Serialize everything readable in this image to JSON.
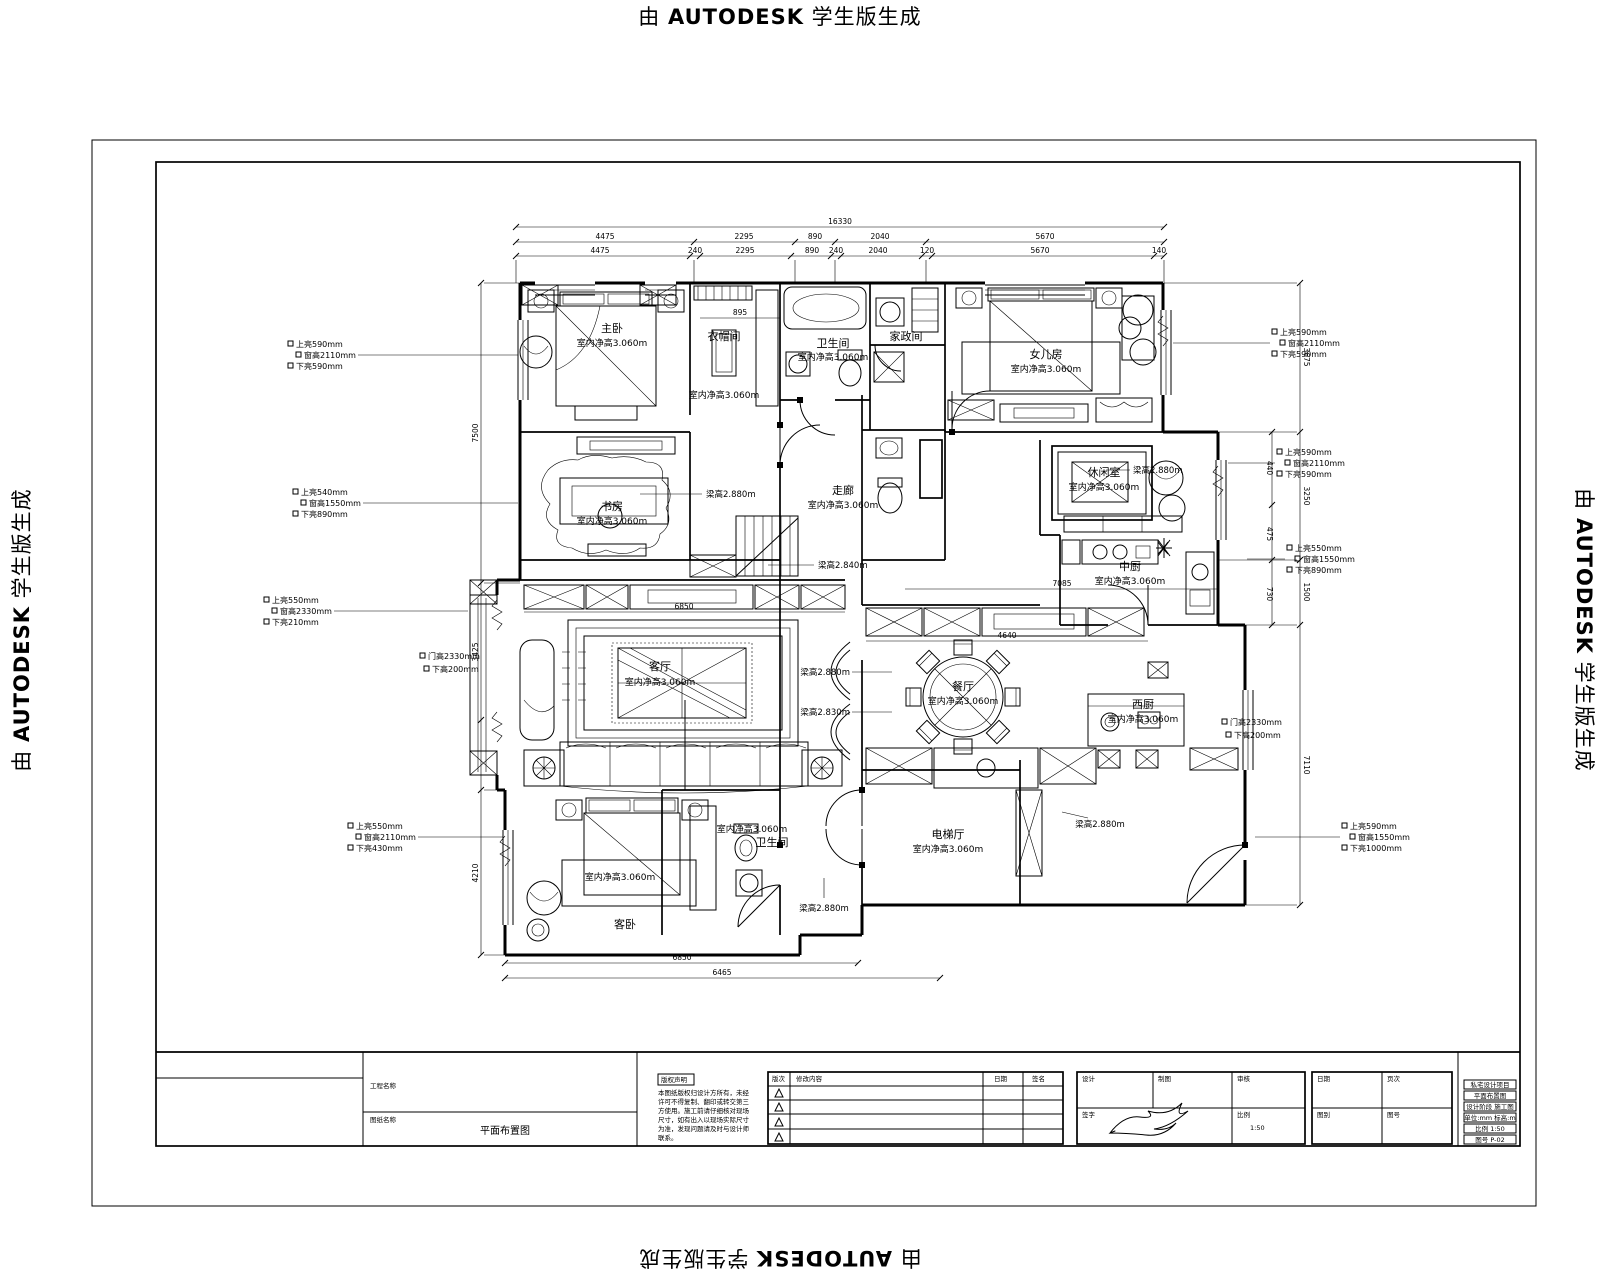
{
  "watermark": {
    "prefix": "由 ",
    "brand": "AUTODESK",
    "suffix": " 学生版生成"
  },
  "rooms": [
    {
      "name": "主卧",
      "h": "室内净高3.060m"
    },
    {
      "name": "衣帽间",
      "h": "室内净高3.060m"
    },
    {
      "name": "卫生间",
      "h": "室内净高3.060m"
    },
    {
      "name": "家政间",
      "h": ""
    },
    {
      "name": "女儿房",
      "h": "室内净高3.060m"
    },
    {
      "name": "书房",
      "h": "室内净高3.060m"
    },
    {
      "name": "走廊",
      "h": "室内净高3.060m"
    },
    {
      "name": "休闲室",
      "h": "室内净高3.060m"
    },
    {
      "name": "中厨",
      "h": "室内净高3.060m"
    },
    {
      "name": "客厅",
      "h": "室内净高3.060m"
    },
    {
      "name": "餐厅",
      "h": "室内净高3.060m"
    },
    {
      "name": "西厨",
      "h": "室内净高3.060m"
    },
    {
      "name": "电梯厅",
      "h": "室内净高3.060m"
    },
    {
      "name": "客卧",
      "h": "室内净高3.060m"
    },
    {
      "name": "卫生间",
      "h": "室内净高3.060m"
    }
  ],
  "beams": [
    "梁高2.880m",
    "梁高2.840m",
    "梁高2.880m",
    "梁高2.830m",
    "梁高2.880m",
    "梁高2.880m",
    "梁高2.880m"
  ],
  "window_tags": [
    {
      "l1": "上亮590mm",
      "l2": "窗高2110mm",
      "l3": "下亮590mm"
    },
    {
      "l1": "上亮540mm",
      "l2": "窗高1550mm",
      "l3": "下亮890mm"
    },
    {
      "l1": "上亮550mm",
      "l2": "窗高2330mm",
      "l3": "下亮210mm"
    },
    {
      "l1": "上亮550mm",
      "l2": "窗高2110mm",
      "l3": "下亮430mm"
    },
    {
      "l1": "上亮590mm",
      "l2": "窗高2110mm",
      "l3": "下亮590mm"
    },
    {
      "l1": "上亮590mm",
      "l2": "窗高2110mm",
      "l3": "下亮590mm"
    },
    {
      "l1": "上亮550mm",
      "l2": "窗高1550mm",
      "l3": "下亮890mm"
    },
    {
      "l1": "上亮590mm",
      "l2": "窗高1550mm",
      "l3": "下亮1000mm"
    }
  ],
  "door_tags": [
    {
      "l1": "门高2330mm",
      "l2": "下高200mm"
    },
    {
      "l1": "门高2330mm",
      "l2": "下高200mm"
    }
  ],
  "dims": {
    "total_top": "16330",
    "t1": [
      "4475",
      "2295",
      "890",
      "2040",
      "5670"
    ],
    "t2": [
      "4475",
      "240",
      "2295",
      "890",
      "240",
      "2040",
      "120",
      "5670",
      "140"
    ],
    "left": [
      "7500",
      "3425",
      "4210"
    ],
    "right": [
      "3675",
      "3250",
      "1500",
      "7110"
    ],
    "right_inner": [
      "440",
      "475",
      "730"
    ],
    "bottom": [
      "6850",
      "6465"
    ],
    "misc": [
      "895",
      "4640",
      "7085",
      "6850"
    ]
  },
  "title_block": {
    "project_label": "工程名称",
    "drawing_label": "图纸名称",
    "drawing_name": "平面布置图",
    "copyright_title": "版权声明",
    "copyright_lines": [
      "本图纸版权归设计方所有，未经",
      "许可不得复制、翻印或转交第三",
      "方使用。施工前请仔细核对现场",
      "尺寸，如有出入以现场实际尺寸",
      "为准，发现问题请及时与设计师",
      "联系。"
    ],
    "rev": {
      "no": "版次",
      "desc": "修改内容",
      "date": "日期",
      "sign": "签名"
    },
    "cells": {
      "design": "设计",
      "draft": "制图",
      "check": "审核",
      "sign": "签字",
      "scale": "比例",
      "scale_val": "1:50",
      "date": "日期",
      "page": "页次",
      "cat": "图别",
      "no": "图号"
    },
    "right_lines": [
      "私宅设计项目",
      "平面布置图",
      "设计阶段 施工图",
      "单位:mm 标高:m",
      "比例 1:50",
      "图号 P-02"
    ]
  }
}
